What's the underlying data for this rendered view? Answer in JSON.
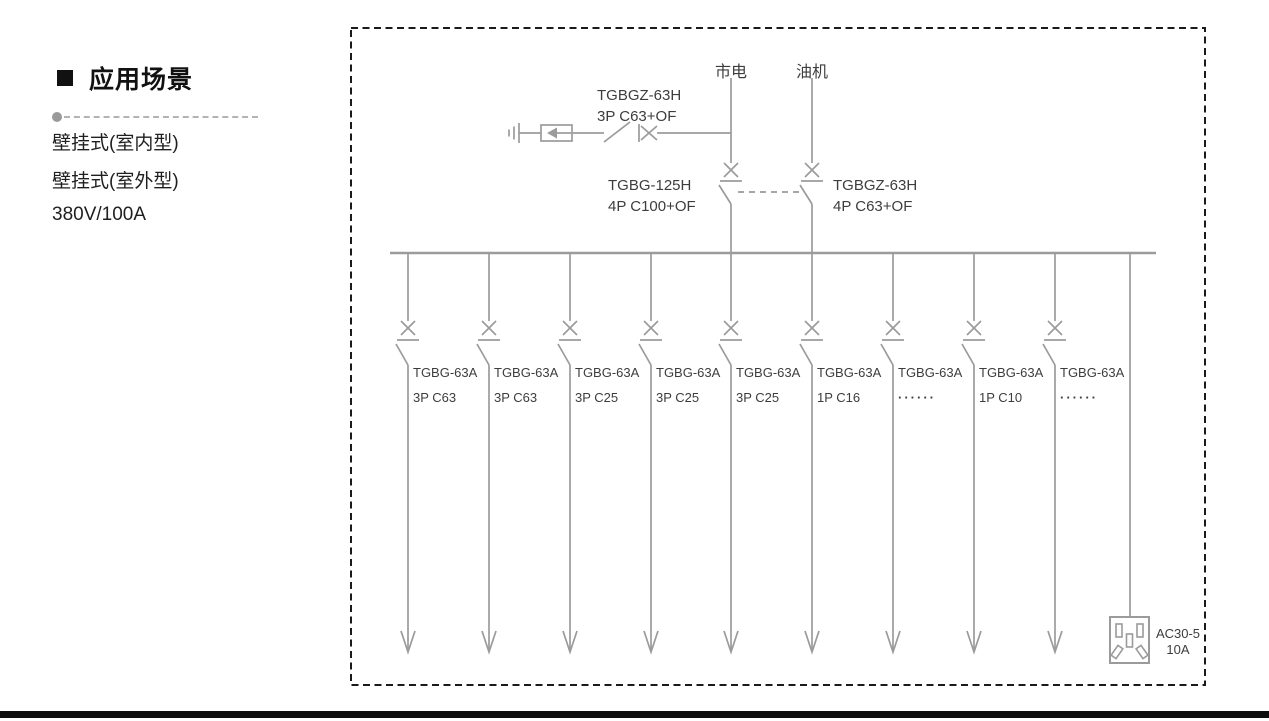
{
  "sidebar": {
    "title": "应用场景",
    "items": [
      "壁挂式(室内型)",
      "壁挂式(室外型)",
      "380V/100A"
    ]
  },
  "diagram": {
    "source_mains": "市电",
    "source_generator": "油机",
    "spd_breaker": {
      "model": "TGBGZ-63H",
      "spec": "3P C63+OF"
    },
    "mains_breaker": {
      "model": "TGBG-125H",
      "spec": "4P C100+OF"
    },
    "generator_breaker": {
      "model": "TGBGZ-63H",
      "spec": "4P C63+OF"
    },
    "branches": [
      {
        "model": "TGBG-63A",
        "spec": "3P C63"
      },
      {
        "model": "TGBG-63A",
        "spec": "3P C63"
      },
      {
        "model": "TGBG-63A",
        "spec": "3P C25"
      },
      {
        "model": "TGBG-63A",
        "spec": "3P C25"
      },
      {
        "model": "TGBG-63A",
        "spec": "3P C25"
      },
      {
        "model": "TGBG-63A",
        "spec": "1P C16"
      },
      {
        "model": "TGBG-63A",
        "spec": "······"
      },
      {
        "model": "TGBG-63A",
        "spec": "1P C10"
      },
      {
        "model": "TGBG-63A",
        "spec": "······"
      }
    ],
    "socket": {
      "model": "AC30-5",
      "rating": "10A"
    }
  },
  "colors": {
    "diagram_line": "#9b9b9b",
    "diagram_text": "#3d3d3d",
    "border": "#1a1a1a",
    "bottom_bar": "#0d0d0d"
  }
}
